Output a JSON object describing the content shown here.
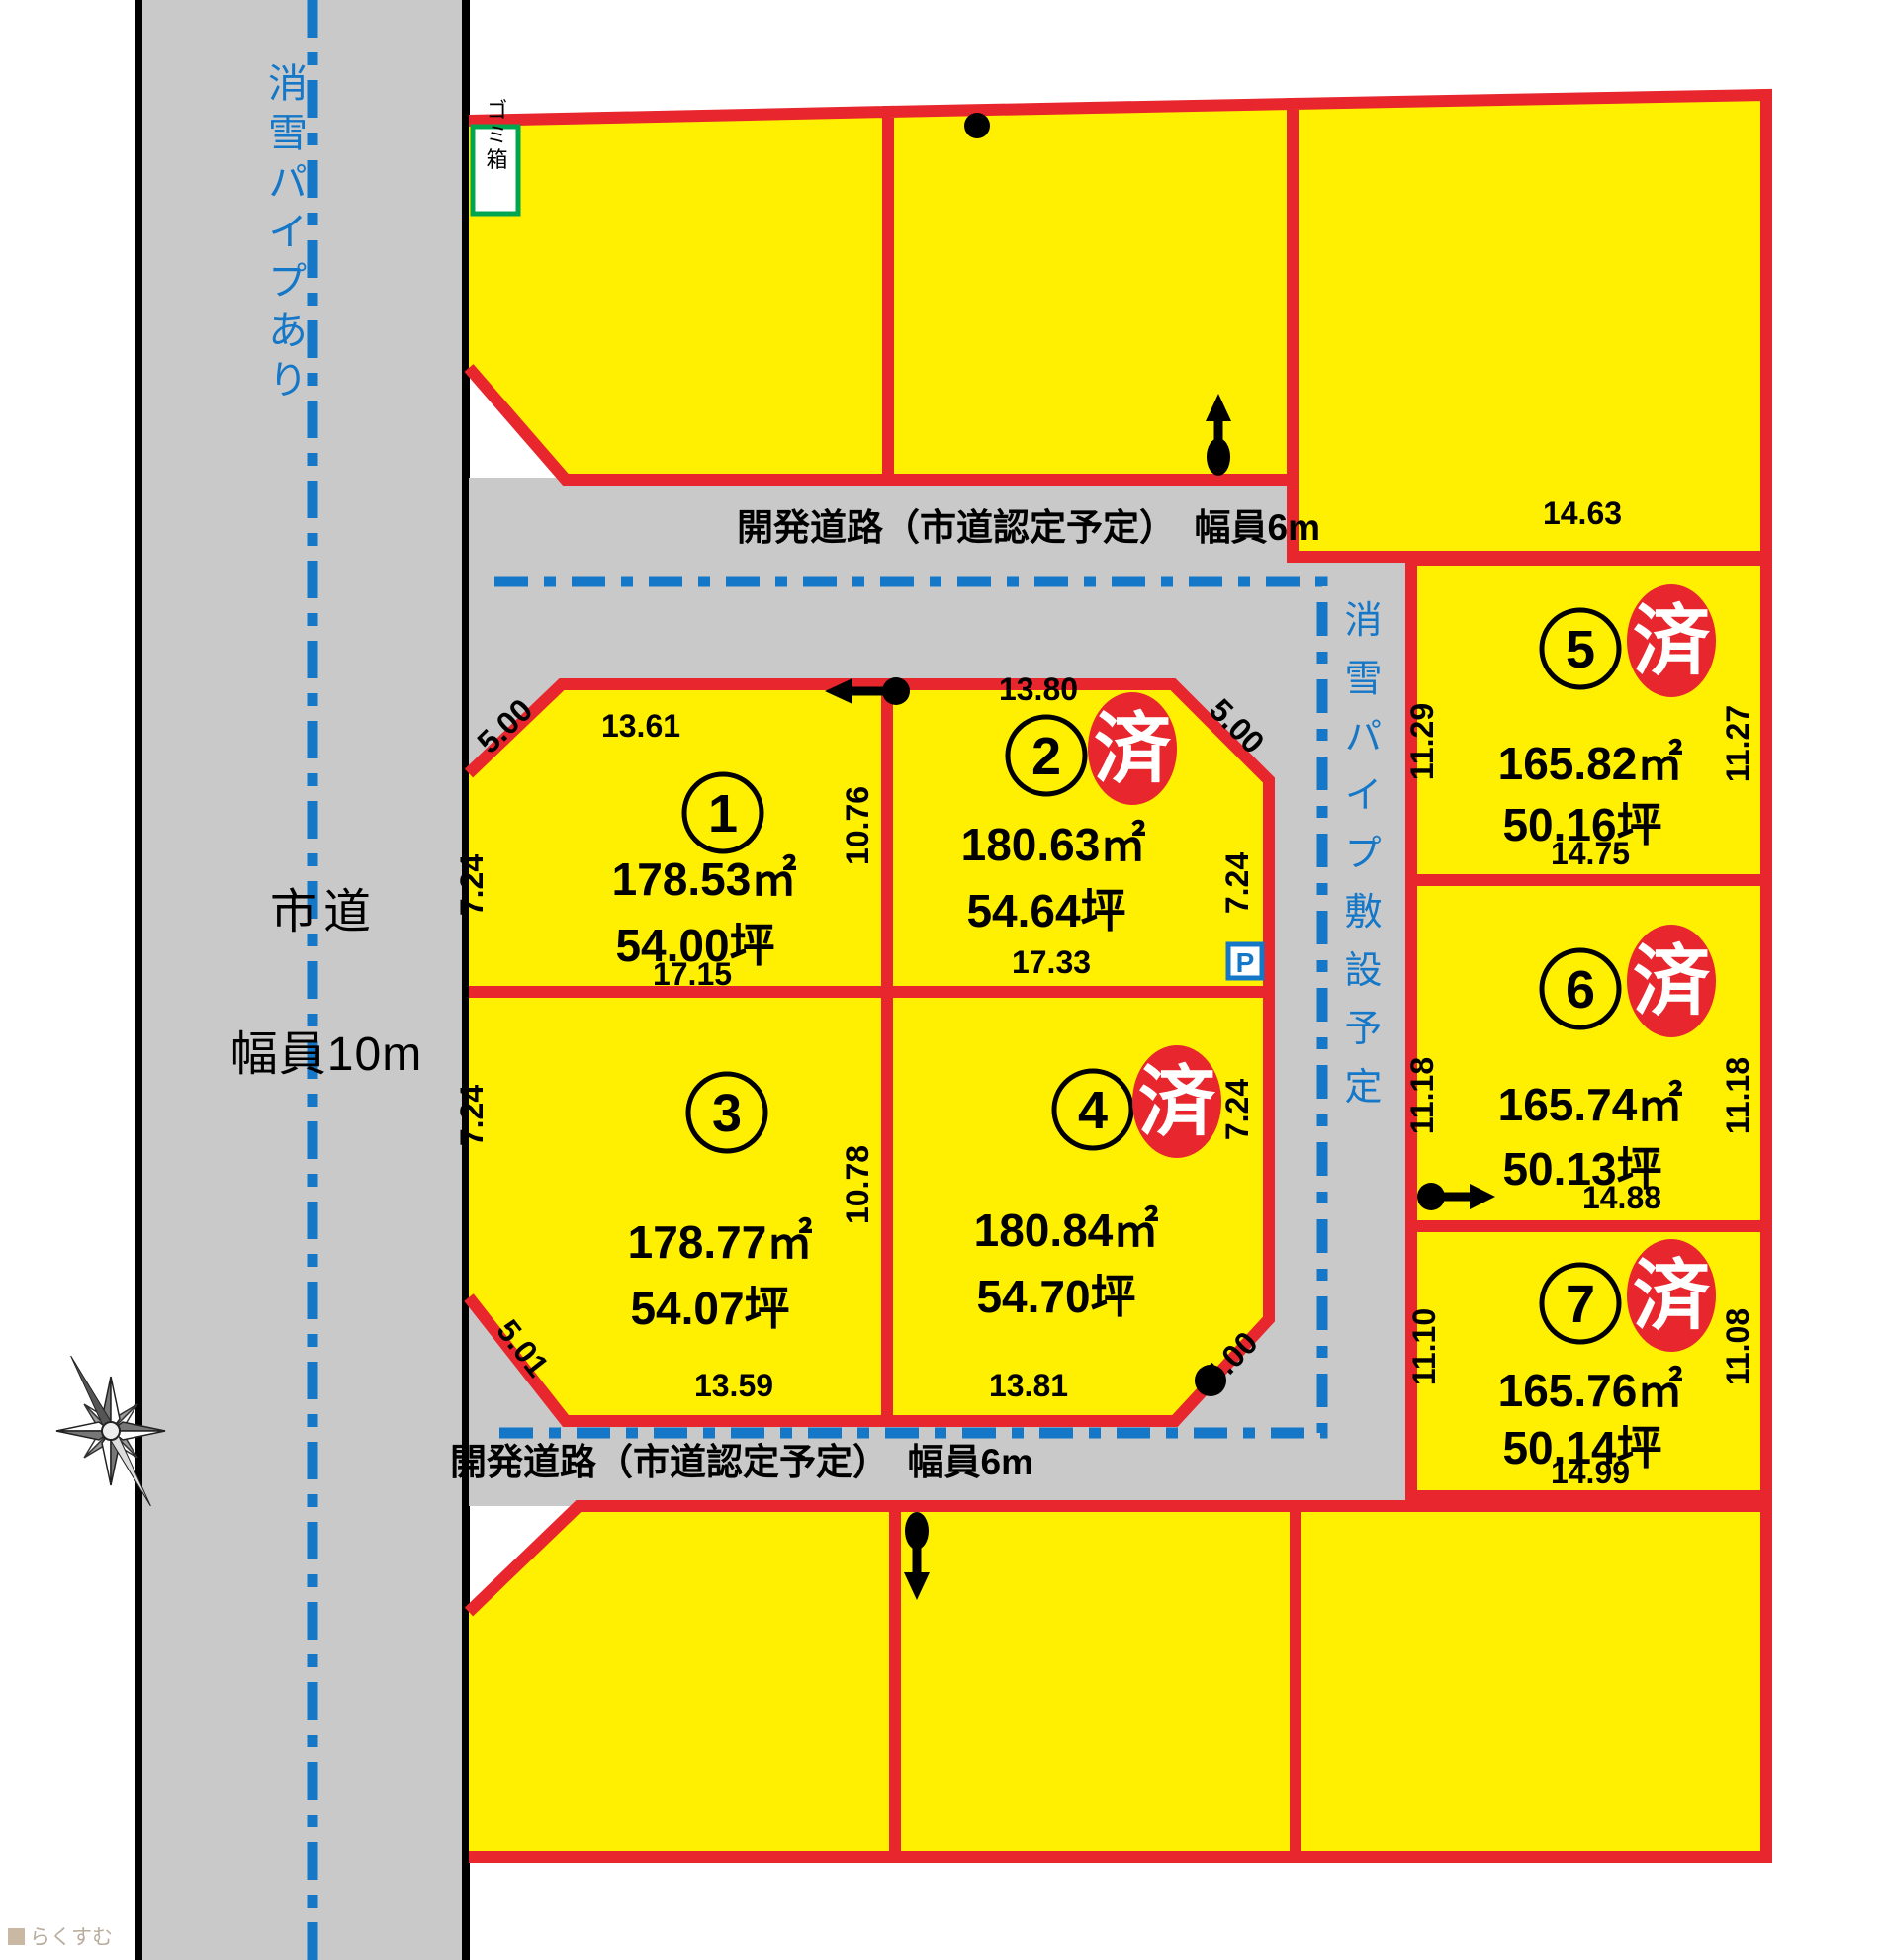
{
  "left_road": {
    "pipe_note": "消雪パイプあり",
    "name": "市道",
    "width": "幅員10m"
  },
  "roads": {
    "top_label": "開発道路（市道認定予定）　幅員6m",
    "bottom_label": "開発道路（市道認定予定）　幅員6m",
    "pipe_plan_note": "消雪パイプ敷設予定"
  },
  "markers": {
    "trash": "ゴミ箱",
    "parking": "P",
    "sold": "済"
  },
  "lots": {
    "lot1": {
      "no": "1",
      "area": "178.53㎡",
      "tsubo": "54.00坪",
      "top": "13.61",
      "corner": "5.00",
      "left": "7.24",
      "bottom": "17.15",
      "right": "10.76"
    },
    "lot2": {
      "no": "2",
      "area": "180.63㎡",
      "tsubo": "54.64坪",
      "top": "13.80",
      "corner": "5.00",
      "right": "7.24",
      "bottom": "17.33"
    },
    "lot3": {
      "no": "3",
      "area": "178.77㎡",
      "tsubo": "54.07坪",
      "left": "7.24",
      "corner": "5.01",
      "bottom": "13.59",
      "right": "10.78"
    },
    "lot4": {
      "no": "4",
      "area": "180.84㎡",
      "tsubo": "54.70坪",
      "right": "7.24",
      "corner": "5.00",
      "bottom": "13.81"
    },
    "lot5": {
      "no": "5",
      "area": "165.82㎡",
      "tsubo": "50.16坪",
      "top": "14.63",
      "left": "11.29",
      "right": "11.27",
      "bottom": "14.75"
    },
    "lot6": {
      "no": "6",
      "area": "165.74㎡",
      "tsubo": "50.13坪",
      "left": "11.18",
      "right": "11.18",
      "bottom": "14.88"
    },
    "lot7": {
      "no": "7",
      "area": "165.76㎡",
      "tsubo": "50.14坪",
      "left": "11.10",
      "right": "11.08",
      "bottom": "14.99"
    }
  },
  "watermark": "らくすむ",
  "colors": {
    "lot_yellow": "#FFEF00",
    "border_red": "#E8262D",
    "road_gray": "#C9C9C9",
    "pipe_blue": "#1577C8",
    "trash_green": "#00A550"
  }
}
